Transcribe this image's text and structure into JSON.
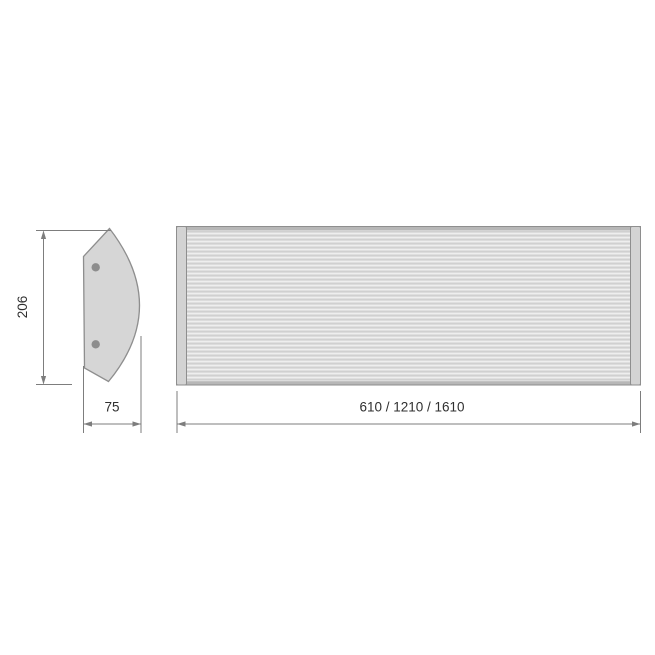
{
  "diagram": {
    "side_view": {
      "height_label": "206",
      "depth_label": "75",
      "mounting_holes": 2
    },
    "front_view": {
      "width_label": "610 / 1210 / 1610"
    },
    "colors": {
      "background": "#ffffff",
      "outline": "#8e8e8e",
      "body_fill": "#d6d6d6",
      "stripe_light": "#eeeeee",
      "stripe_dark": "#d0d0d0",
      "cap_fill": "#d3d3d3",
      "edge_band": "#b7b7b7",
      "hole_fill": "#8d8d8d",
      "dimension_line": "#7d7d7d",
      "label_text": "#2f2f2f"
    }
  }
}
